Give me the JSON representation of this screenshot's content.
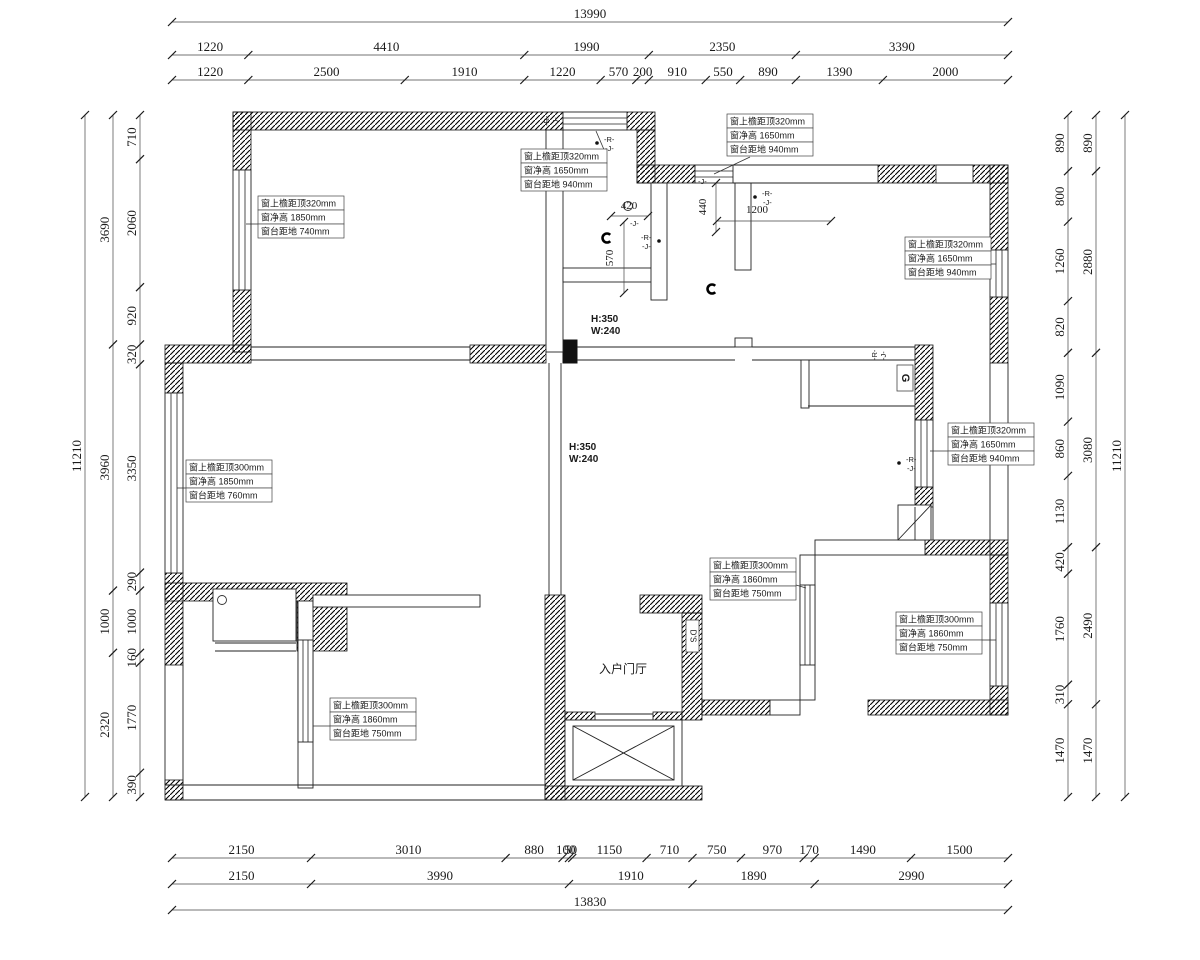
{
  "drawing": {
    "colors": {
      "ink": "#1a1a1a",
      "paper": "#ffffff"
    },
    "dims": {
      "top": {
        "total": "13990",
        "row2": [
          "1220",
          "4410",
          "1990",
          "2350",
          "3390"
        ],
        "row3": [
          "1220",
          "2500",
          "1910",
          "1220",
          "570",
          "200",
          "910",
          "550",
          "890",
          "1390",
          "2000"
        ]
      },
      "bottom": {
        "row1": [
          "2150",
          "3010",
          "880",
          "100",
          "50",
          "1150",
          "710",
          "750",
          "970",
          "170",
          "1490",
          "1500"
        ],
        "row2": [
          "2150",
          "3990",
          "1910",
          "1890",
          "2990"
        ],
        "total": "13830"
      },
      "left": {
        "total": "11210",
        "mid": [
          "3690",
          "3960",
          "1000",
          "2320"
        ],
        "inner": [
          "710",
          "2060",
          "920",
          "320",
          "3350",
          "290",
          "1000",
          "160",
          "1770",
          "390"
        ]
      },
      "right": {
        "total": "11210",
        "mid": [
          "890",
          "2880",
          "3080",
          "2490",
          "1470"
        ],
        "inner": [
          "890",
          "800",
          "1260",
          "820",
          "1090",
          "860",
          "1130",
          "420.",
          "1760",
          "310",
          "1470"
        ]
      }
    },
    "window_annotations": [
      {
        "x": 258,
        "y": 196,
        "lines": [
          "窗上檐距顶320mm",
          "窗净高  1850mm",
          "窗台距地  740mm"
        ],
        "leader": [
          258,
          224,
          246,
          224
        ]
      },
      {
        "x": 521,
        "y": 149,
        "lines": [
          "窗上檐距顶320mm",
          "窗净高  1650mm",
          "窗台距地  940mm"
        ],
        "leader": [
          605,
          152,
          596,
          131
        ]
      },
      {
        "x": 727,
        "y": 114,
        "lines": [
          "窗上檐距顶320mm",
          "窗净高  1650mm",
          "窗台距地  940mm"
        ],
        "leader": [
          750,
          157,
          714,
          174
        ]
      },
      {
        "x": 905,
        "y": 237,
        "lines": [
          "窗上檐距顶320mm",
          "窗净高  1650mm",
          "窗台距地  940mm"
        ],
        "leader": [
          991,
          264,
          996,
          264
        ]
      },
      {
        "x": 186,
        "y": 460,
        "lines": [
          "窗上檐距顶300mm",
          "窗净高  1850mm",
          "窗台距地  760mm"
        ],
        "leader": [
          186,
          488,
          177,
          488
        ]
      },
      {
        "x": 948,
        "y": 423,
        "lines": [
          "窗上檐距顶320mm",
          "窗净高  1650mm",
          "窗台距地  940mm"
        ],
        "leader": [
          948,
          451,
          930,
          451
        ]
      },
      {
        "x": 710,
        "y": 558,
        "lines": [
          "窗上檐距顶300mm",
          "窗净高  1860mm",
          "窗台距地  750mm"
        ],
        "leader": [
          796,
          585,
          806,
          588
        ]
      },
      {
        "x": 896,
        "y": 612,
        "lines": [
          "窗上檐距顶300mm",
          "窗净高  1860mm",
          "窗台距地  750mm"
        ],
        "leader": [
          982,
          640,
          996,
          640
        ]
      },
      {
        "x": 330,
        "y": 698,
        "lines": [
          "窗上檐距顶300mm",
          "窗净高  1860mm",
          "窗台距地  750mm"
        ],
        "leader": [
          330,
          726,
          313,
          726
        ]
      }
    ],
    "beam_labels": [
      {
        "x": 591,
        "y": 322,
        "lines": [
          "H:350",
          "W:240"
        ]
      },
      {
        "x": 569,
        "y": 450,
        "lines": [
          "H:350",
          "W:240"
        ]
      }
    ],
    "room_labels": [
      {
        "x": 623,
        "y": 673,
        "text": "入户门厅"
      }
    ],
    "inline_dims": [
      {
        "text": "420",
        "x": 629,
        "y": 209,
        "orient": "h",
        "line": [
          611,
          216,
          648,
          216
        ]
      },
      {
        "text": "570",
        "x": 613,
        "y": 258,
        "orient": "v",
        "line": [
          624,
          222,
          624,
          293
        ]
      },
      {
        "text": "440",
        "x": 706,
        "y": 207,
        "orient": "v",
        "line": [
          716,
          183,
          716,
          232
        ]
      },
      {
        "text": "1200",
        "x": 757,
        "y": 213,
        "orient": "h",
        "line": [
          717,
          221,
          831,
          221
        ]
      }
    ],
    "markers": [
      {
        "type": "rj",
        "x": 604,
        "y": 142,
        "dot": "l",
        "lines": [
          "-R-",
          "-J-"
        ]
      },
      {
        "type": "rj",
        "x": 641,
        "y": 240,
        "dot": "r",
        "lines": [
          "-R-",
          "-J-"
        ]
      },
      {
        "type": "rj",
        "x": 762,
        "y": 196,
        "dot": "l",
        "lines": [
          "-R-",
          "-J-"
        ]
      },
      {
        "type": "rj",
        "x": 906,
        "y": 462,
        "dot": "l",
        "lines": [
          "-R-",
          "-J-"
        ]
      },
      {
        "type": "rj_rot",
        "x": 549,
        "y": 126,
        "lines": [
          "-R-",
          "-J-"
        ]
      },
      {
        "type": "rj_rot",
        "x": 877,
        "y": 360,
        "lines": [
          "-R-",
          "-J-"
        ]
      },
      {
        "type": "j",
        "x": 698,
        "y": 184,
        "text": "-J-"
      },
      {
        "type": "j",
        "x": 630,
        "y": 226,
        "text": "-J-"
      },
      {
        "type": "lamp",
        "x": 607,
        "y": 238
      },
      {
        "type": "lamp",
        "x": 712,
        "y": 289
      },
      {
        "type": "circle",
        "x": 628,
        "y": 206
      },
      {
        "type": "circle",
        "x": 222,
        "y": 600
      },
      {
        "type": "gbox",
        "x": 897,
        "y": 365,
        "text": "G"
      },
      {
        "type": "dsbox",
        "x": 686,
        "y": 620,
        "text": "D'S"
      }
    ]
  }
}
